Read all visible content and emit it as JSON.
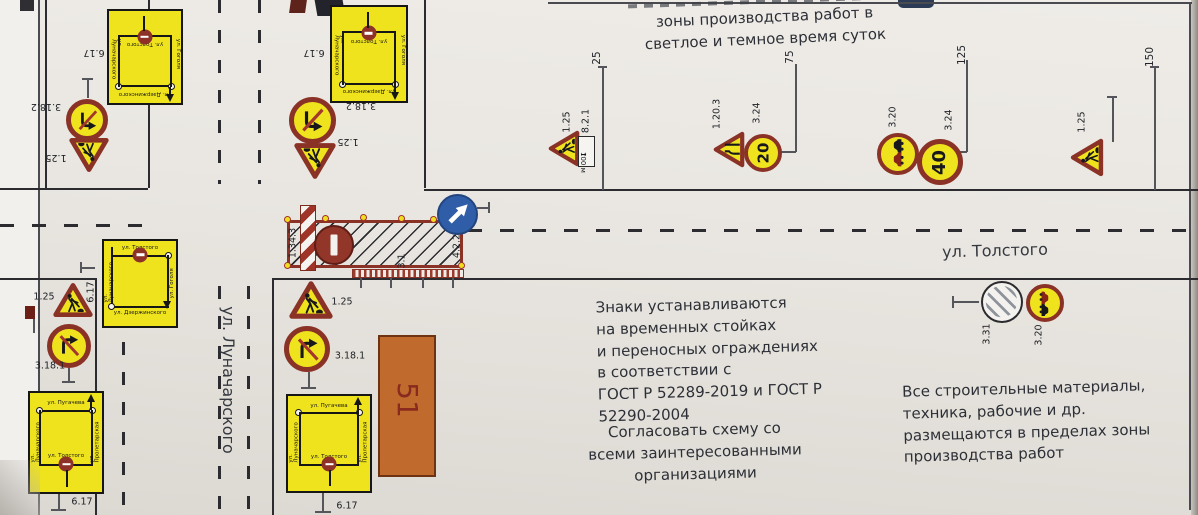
{
  "top_note": {
    "text": "зоны производства работ в\nсветлое и темное время суток"
  },
  "legend": {
    "install_text": "Знаки устанавливаются\nна временных стойках\nи переносных  ограждениях\nв соответствии с\nГОСТ Р 52289-2019 и ГОСТ Р\n52290-2004",
    "agree_text": "Согласовать схему со\nвсеми заинтересованными\nорганизациями",
    "materials_text": "Все строительные материалы,\nтехника, рабочие и др.\nразмещаются в пределах зоны\nпроизводства работ"
  },
  "streets": {
    "tolstogo": "ул. Толстого",
    "lunacharskogo": "ул. Луначарского"
  },
  "building": {
    "number": "51"
  },
  "dims": {
    "d25": "25",
    "d75": "75",
    "d125": "125",
    "d150": "150"
  },
  "signs": {
    "n1_25": "1.25",
    "n3_18_2": "3.18.2",
    "n3_18_1": "3.18.1",
    "n6_17": "6.17",
    "n8_2_1": "8.2.1",
    "n1_20_3": "1.20.3",
    "n3_24": "3.24",
    "n3_20": "3.20",
    "n3_31": "3.31",
    "n3_1": "3.1",
    "n1_34_3": "1.34.3",
    "n4_2_2": "4.2.2",
    "plate_text": "100 м",
    "speed_20": "20",
    "speed_40": "40"
  },
  "icons": {
    "plate_arrow": "↑"
  },
  "detour": {
    "north": {
      "top": "ул. Дзержинского",
      "left": "ул. Гоголя",
      "right": "ул. Луначарского",
      "bottom": "ул. Толстого"
    },
    "west": {
      "top": "ул. Толстого",
      "left": "ул. Луначарского",
      "right": "ул. Гоголя",
      "bottom": "ул. Дзержинского"
    },
    "south": {
      "top": "ул. Пугачева",
      "left": "ул. Луначарского",
      "right": "ул. Пролетарская",
      "bottom": "ул. Толстого"
    }
  },
  "colors": {
    "sign_yellow": "#efe31d",
    "sign_red": "#8b3227",
    "blue_sign": "#2f5da8",
    "building_orange": "#c06a2e",
    "paper": "#e9e6e1"
  }
}
